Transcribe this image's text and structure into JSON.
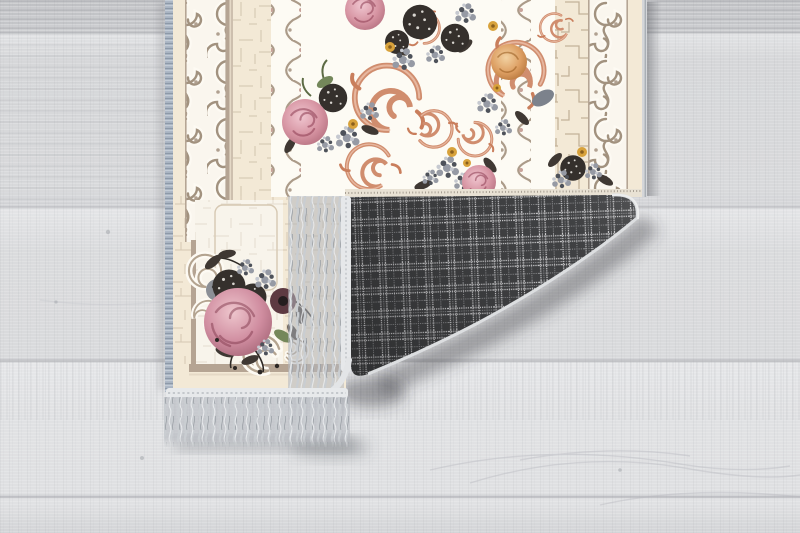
{
  "scene": {
    "type": "product-photograph",
    "subject": "Floral baroque runner rug on a light gray wood floor, bottom-right corner folded over showing dark gray plaid backing and gray fringe tassels",
    "floor": {
      "material": "whitewashed wood planks",
      "plank_seams_y": [
        33,
        207,
        361,
        497
      ]
    },
    "rug": {
      "style": "cream baroque border with taupe scrollwork, ivory center field with rose bouquets linked by salmon scrolls",
      "edges": "blue-gray selvage on left edge, gray fringe on bottom edge",
      "motifs": [
        "pink roses",
        "peach rose",
        "dark foliage pompoms",
        "gray-blue floret clusters",
        "yellow buds",
        "salmon baroque swirls",
        "crackle texture",
        "greek-key meander band"
      ]
    },
    "fold": {
      "backing": "charcoal windowpane plaid weave",
      "fringe": "light gray tassel fringe along folded edge and bottom edge"
    }
  },
  "colors": {
    "floor": "#d9dadc",
    "floorSeam": "#b2b3b7",
    "rugCream": "#f3e9d6",
    "rugIvory": "#fdfbf4",
    "borderTaupe": "#b0a090",
    "crackleLine": "#cdbfa8",
    "swirlSalmon": "#d08d6e",
    "rosePink": "#d495a4",
    "roseDustyPink": "#d08da0",
    "rosePeach": "#d89c59",
    "foliageDark": "#38322d",
    "maroonFlower": "#5d3a42",
    "floretGray": "#969aa4",
    "accentYellow": "#d8a23b",
    "leafGreen": "#71854f",
    "plaidBase": "#3f4042",
    "plaidBrightLine": "#d2d2d4",
    "plaidMidLine": "#909194",
    "fringe": "#c9cdd1",
    "fringeHeader": "#e8eaec",
    "selvageBlue": "#a9b4c2",
    "shadow": "rgba(60,62,68,0.40)"
  }
}
